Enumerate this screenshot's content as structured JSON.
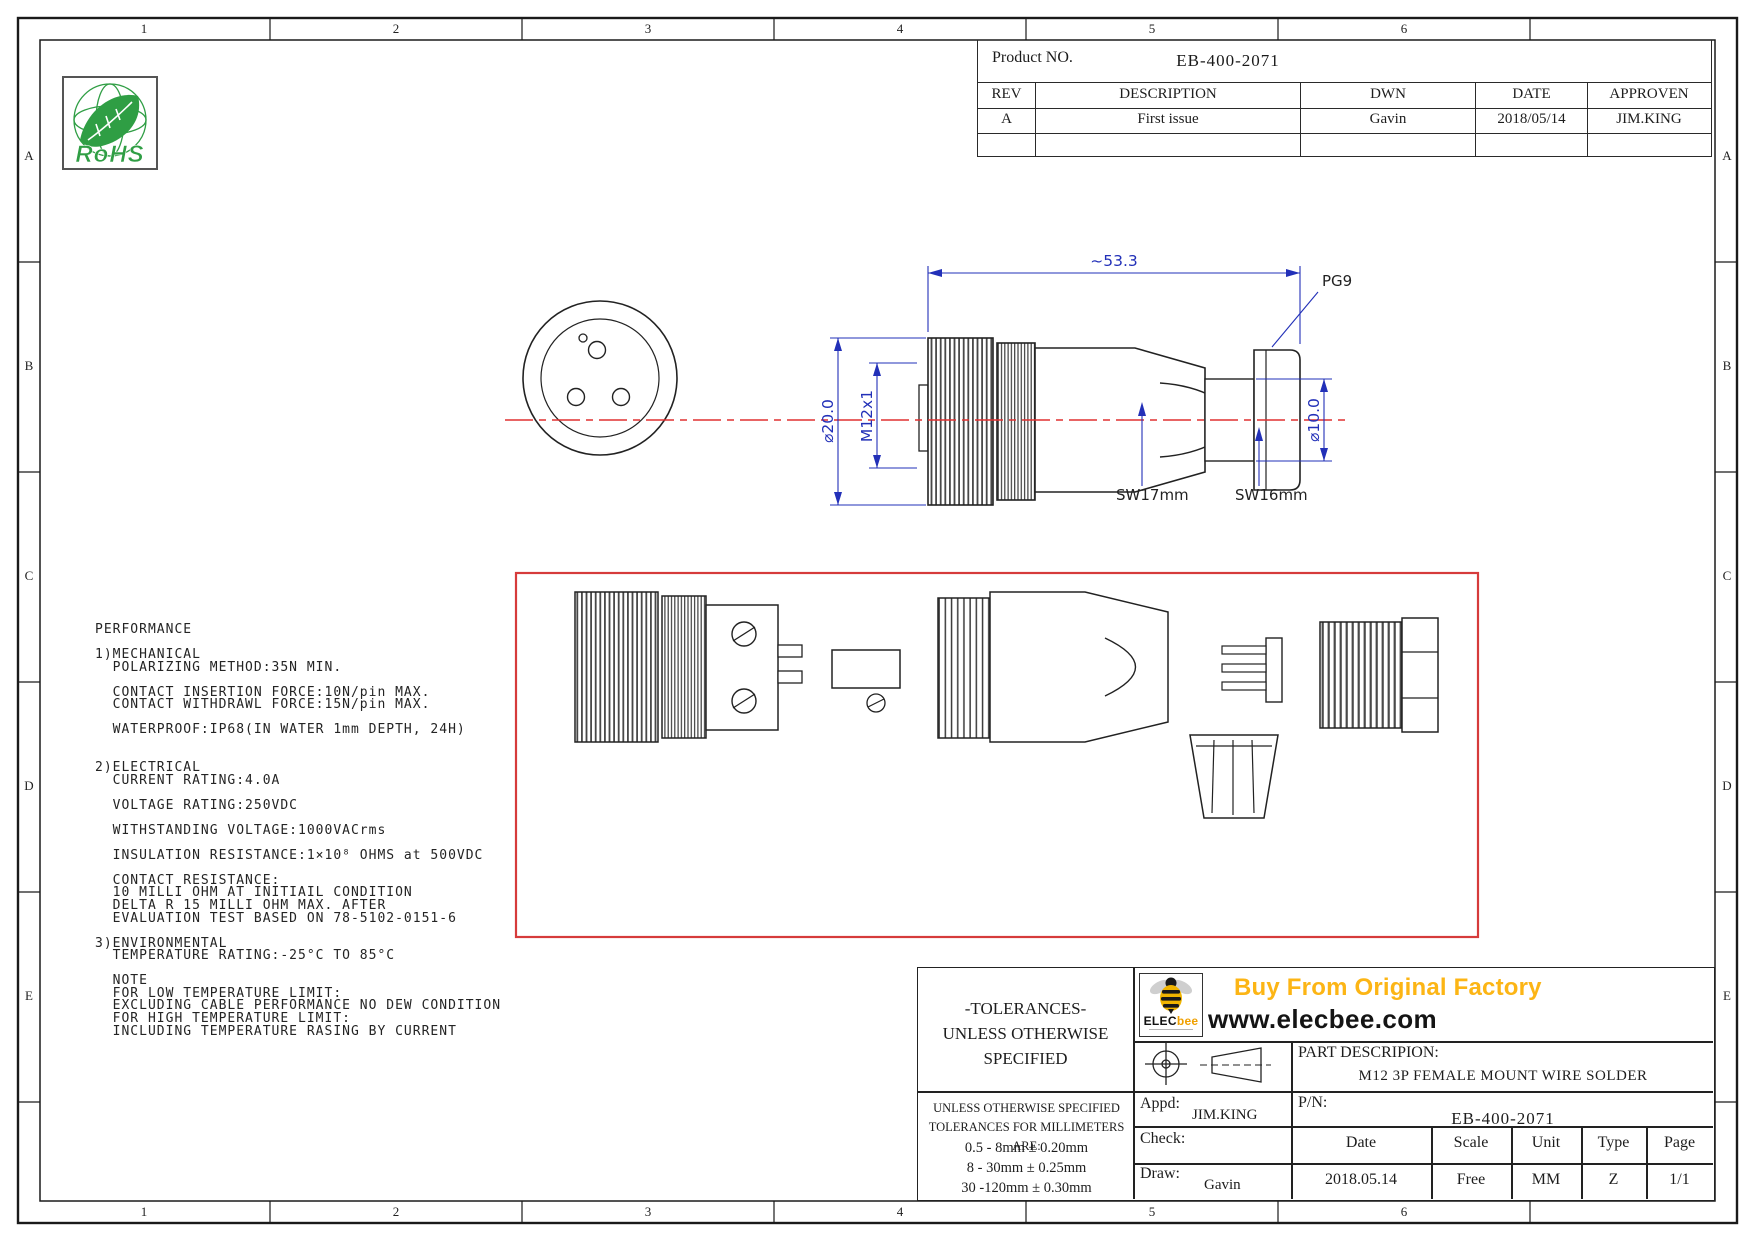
{
  "colors": {
    "dim_blue": "#2230b8",
    "centerline_red": "#e03131",
    "exploded_box_red": "#d63b3b",
    "rohs_green": "#2f9e44",
    "brand_orange": "#fcb515",
    "bee_yellow": "#f0b400"
  },
  "frame": {
    "cols": [
      "1",
      "2",
      "3",
      "4",
      "5",
      "6"
    ],
    "rows": [
      "A",
      "B",
      "C",
      "D",
      "E"
    ]
  },
  "rohs": {
    "label": "RoHS"
  },
  "rev_table": {
    "product_label": "Product NO.",
    "product_value": "EB-400-2071",
    "headers": [
      "REV",
      "DESCRIPTION",
      "DWN",
      "DATE",
      "APPROVEN"
    ],
    "row": [
      "A",
      "First issue",
      "Gavin",
      "2018/05/14",
      "JIM.KING"
    ]
  },
  "drawing": {
    "dim_length": "~53.3",
    "dim_outer_dia": "⌀20.0",
    "dim_thread": "M12x1",
    "dim_cable_dia": "⌀10.0",
    "label_gland": "PG9",
    "label_sw17": "SW17mm",
    "label_sw16": "SW16mm"
  },
  "performance": {
    "text": "PERFORMANCE\n\n1)MECHANICAL\n  POLARIZING METHOD:35N MIN.\n\n  CONTACT INSERTION FORCE:10N/pin MAX.\n  CONTACT WITHDRAWL FORCE:15N/pin MAX.\n\n  WATERPROOF:IP68(IN WATER 1mm DEPTH, 24H)\n\n\n2)ELECTRICAL\n  CURRENT RATING:4.0A\n\n  VOLTAGE RATING:250VDC\n\n  WITHSTANDING VOLTAGE:1000VACrms\n\n  INSULATION RESISTANCE:1×10⁸ OHMS at 500VDC\n\n  CONTACT RESISTANCE:\n  10 MILLI OHM AT INITIAIL CONDITION\n  DELTA R 15 MILLI OHM MAX. AFTER\n  EVALUATION TEST BASED ON 78-5102-0151-6\n\n3)ENVIRONMENTAL\n  TEMPERATURE RATING:-25°C TO 85°C\n\n  NOTE\n  FOR LOW TEMPERATURE LIMIT:\n  EXCLUDING CABLE PERFORMANCE NO DEW CONDITION\n  FOR HIGH TEMPERATURE LIMIT:\n  INCLUDING TEMPERATURE RASING BY CURRENT"
  },
  "title_block": {
    "tolerances_heading": "-TOLERANCES-\nUNLESS OTHERWISE\nSPECIFIED",
    "tolerances_note": "UNLESS OTHERWISE SPECIFIED\nTOLERANCES FOR MILLIMETERS ARE:",
    "tolerances_rows": "0.5 - 8mm ± 0.20mm\n8 - 30mm ± 0.25mm\n30 -120mm ± 0.30mm",
    "appd_label": "Appd:",
    "appd_value": "JIM.KING",
    "check_label": "Check:",
    "draw_label": "Draw:",
    "draw_value": "Gavin",
    "part_desc_label": "PART DESCRIPION:",
    "part_desc_value": "M12 3P FEMALE MOUNT WIRE SOLDER",
    "pn_label": "P/N:",
    "pn_value": "EB-400-2071",
    "col_headers": {
      "date": "Date",
      "scale": "Scale",
      "unit": "Unit",
      "type": "Type",
      "page": "Page"
    },
    "col_values": {
      "date": "2018.05.14",
      "scale": "Free",
      "unit": "MM",
      "type": "Z",
      "page": "1/1"
    },
    "brand": {
      "headline": "Buy From Original Factory",
      "website": "www.elecbee.com",
      "logo_black": "ELEC",
      "logo_orange": "bee"
    }
  }
}
